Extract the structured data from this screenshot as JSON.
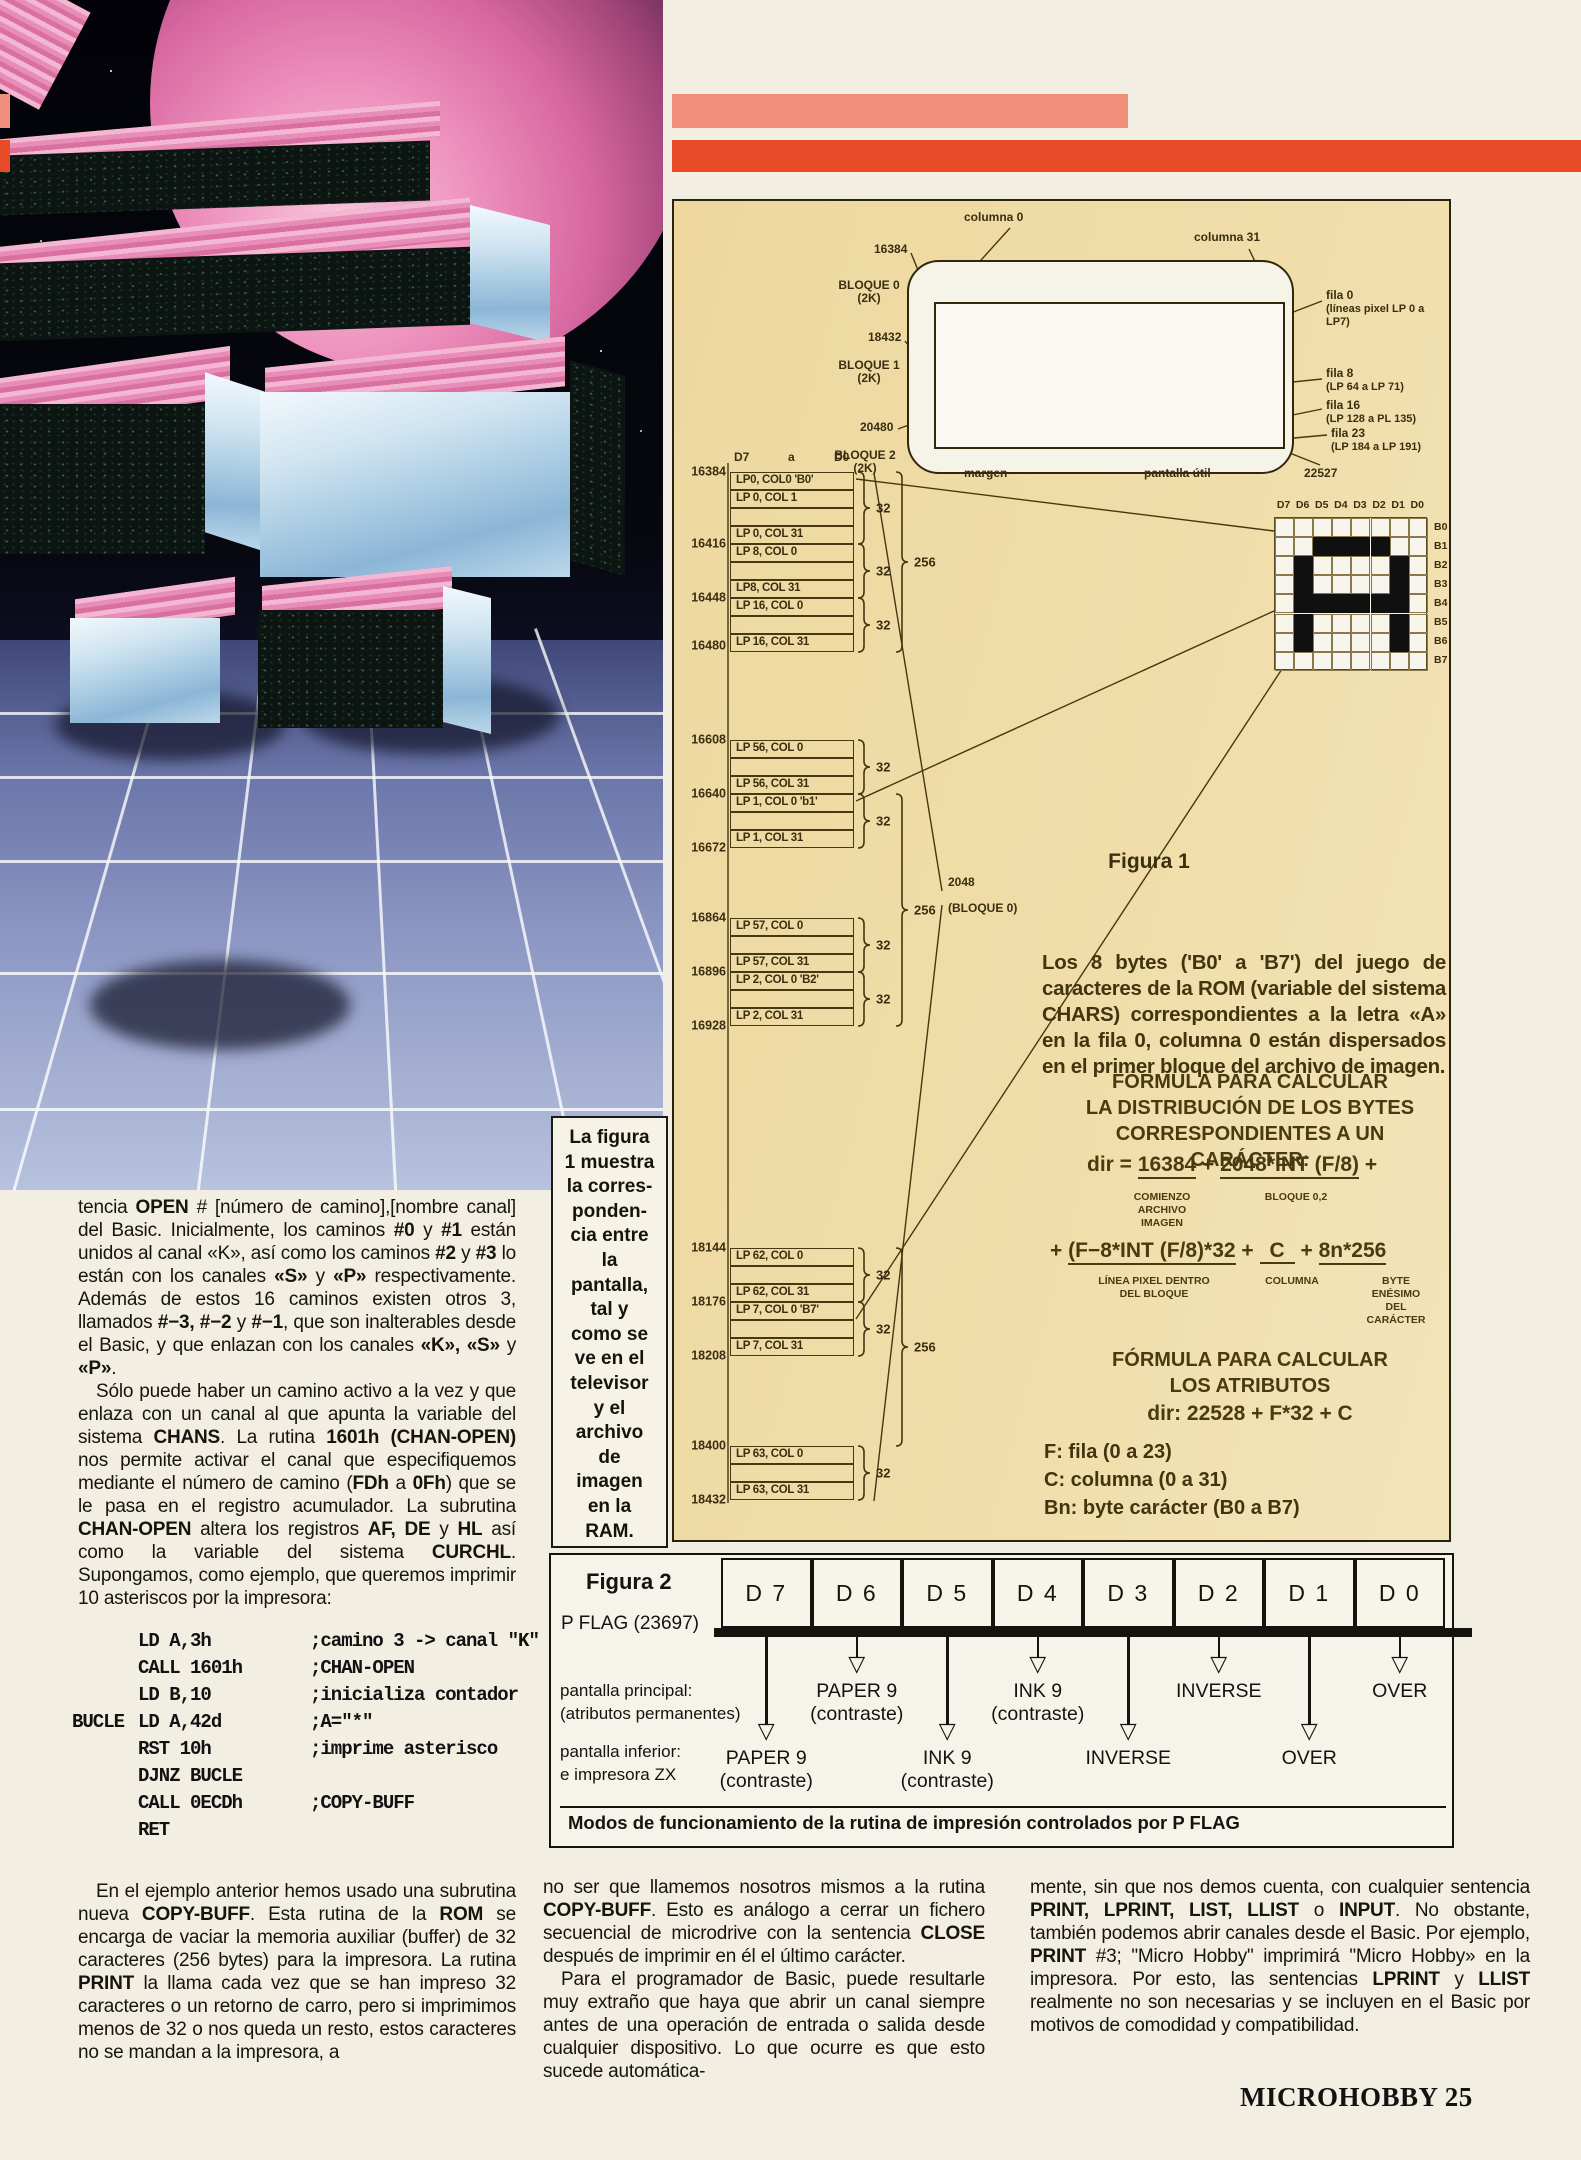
{
  "colors": {
    "stripe_red": "#e84b28",
    "stripe_salmon": "#f0907a",
    "panel_tan": "#eed9a2",
    "page": "#f2eee2"
  },
  "figura1": {
    "figura_label": "Figura 1",
    "tv": {
      "col0": "columna 0",
      "col31": "columna 31",
      "addr_left": [
        "16384",
        "18432",
        "20480"
      ],
      "blocks": [
        {
          "l1": "BLOQUE 0",
          "l2": "(2K)"
        },
        {
          "l1": "BLOQUE 1",
          "l2": "(2K)"
        },
        {
          "l1": "BLOQUE 2",
          "l2": "(2K)"
        }
      ],
      "filas": [
        {
          "l1": "fila 0",
          "l2": "(líneas pixel LP 0 a LP7)"
        },
        {
          "l1": "fila 8",
          "l2": "(LP 64 a LP 71)"
        },
        {
          "l1": "fila 16",
          "l2": "(LP 128 a PL 135)"
        },
        {
          "l1": "fila 23",
          "l2": "(LP 184 a LP 191)"
        }
      ],
      "margen": "margen",
      "pantalla_util": "pantalla útil",
      "addr_bottom": "22527"
    },
    "bus": {
      "d7": "D7",
      "a": "a",
      "d0": "D0"
    },
    "memory_map": {
      "cells": [
        {
          "top": 0,
          "label": "LP0, COL0 'B0'"
        },
        {
          "top": 18,
          "label": "LP 0, COL 1"
        },
        {
          "top": 36,
          "label": ""
        },
        {
          "top": 54,
          "label": "LP 0, COL 31"
        },
        {
          "top": 72,
          "label": "LP 8, COL 0"
        },
        {
          "top": 90,
          "label": ""
        },
        {
          "top": 108,
          "label": "LP8, COL 31"
        },
        {
          "top": 126,
          "label": "LP 16, COL 0"
        },
        {
          "top": 144,
          "label": ""
        },
        {
          "top": 162,
          "label": "LP 16, COL 31"
        },
        {
          "top": 268,
          "label": "LP 56, COL 0"
        },
        {
          "top": 286,
          "label": ""
        },
        {
          "top": 304,
          "label": "LP 56, COL 31"
        },
        {
          "top": 322,
          "label": "LP 1, COL 0 'b1'"
        },
        {
          "top": 340,
          "label": ""
        },
        {
          "top": 358,
          "label": "LP 1, COL 31"
        },
        {
          "top": 446,
          "label": "LP 57, COL 0"
        },
        {
          "top": 464,
          "label": ""
        },
        {
          "top": 482,
          "label": "LP 57, COL 31"
        },
        {
          "top": 500,
          "label": "LP 2, COL 0 'B2'"
        },
        {
          "top": 518,
          "label": ""
        },
        {
          "top": 536,
          "label": "LP 2, COL 31"
        },
        {
          "top": 776,
          "label": "LP 62, COL 0"
        },
        {
          "top": 794,
          "label": ""
        },
        {
          "top": 812,
          "label": "LP 62, COL 31"
        },
        {
          "top": 830,
          "label": "LP 7, COL 0 'B7'"
        },
        {
          "top": 848,
          "label": ""
        },
        {
          "top": 866,
          "label": "LP 7, COL 31"
        },
        {
          "top": 974,
          "label": "LP 63, COL 0"
        },
        {
          "top": 992,
          "label": ""
        },
        {
          "top": 1010,
          "label": "LP 63, COL 31"
        }
      ],
      "addresses": [
        {
          "y": 0,
          "label": "16384"
        },
        {
          "y": 72,
          "label": "16416"
        },
        {
          "y": 126,
          "label": "16448"
        },
        {
          "y": 174,
          "label": "16480"
        },
        {
          "y": 268,
          "label": "16608"
        },
        {
          "y": 322,
          "label": "16640"
        },
        {
          "y": 376,
          "label": "16672"
        },
        {
          "y": 446,
          "label": "16864"
        },
        {
          "y": 500,
          "label": "16896"
        },
        {
          "y": 554,
          "label": "16928"
        },
        {
          "y": 776,
          "label": "18144"
        },
        {
          "y": 830,
          "label": "18176"
        },
        {
          "y": 884,
          "label": "18208"
        },
        {
          "y": 974,
          "label": "18400"
        },
        {
          "y": 1028,
          "label": "18432"
        }
      ],
      "label_32": "32",
      "braces_32": [
        {
          "y1": 0,
          "y2": 72
        },
        {
          "y1": 72,
          "y2": 126
        },
        {
          "y1": 126,
          "y2": 180
        },
        {
          "y1": 268,
          "y2": 322
        },
        {
          "y1": 322,
          "y2": 376
        },
        {
          "y1": 446,
          "y2": 500
        },
        {
          "y1": 500,
          "y2": 554
        },
        {
          "y1": 776,
          "y2": 830
        },
        {
          "y1": 830,
          "y2": 884
        },
        {
          "y1": 974,
          "y2": 1028
        }
      ],
      "label_256": "256",
      "braces_256": [
        {
          "y1": 0,
          "y2": 180,
          "ly": 90
        },
        {
          "y1": 322,
          "y2": 554,
          "ly": 438
        },
        {
          "y1": 776,
          "y2": 974,
          "ly": 875
        }
      ],
      "block_label_line1": "2048",
      "block_label_line2": "(BLOQUE 0)"
    },
    "char_grid": {
      "headers": [
        "D7",
        "D6",
        "D5",
        "D4",
        "D3",
        "D2",
        "D1",
        "D0"
      ],
      "row_labels": [
        "B0",
        "B1",
        "B2",
        "B3",
        "B4",
        "B5",
        "B6",
        "B7"
      ],
      "bitmap": [
        "00000000",
        "00111100",
        "01000010",
        "01000010",
        "01111110",
        "01000010",
        "01000010",
        "00000000"
      ]
    },
    "text_html": "<b>Los 8 bytes</b> (<b>'B0'</b> a <b>'B7'</b>) del juego de caracteres de la ROM (variable del sistema CHARS) correspondientes a la letra «A» en la fila 0, columna 0 están dispersados en el primer bloque del archivo de imagen.",
    "formula_title": [
      "FÓRMULA PARA CALCULAR",
      "LA DISTRIBUCIÓN DE LOS BYTES",
      "CORRESPONDIENTES A UN CARÁCTER:"
    ],
    "f1": {
      "lead": "dir = ",
      "t1": "16384",
      "plus1": " + ",
      "t2": "2048*INT (F/8)",
      "tail": " +",
      "sub1": "COMIENZO\nARCHIVO\nIMAGEN",
      "sub2": "BLOQUE 0,2"
    },
    "f2": {
      "lead": "+ ",
      "t1": "(F−8*INT (F/8)*32",
      "plus1": " + ",
      "t2": "C",
      "plus2": " + ",
      "t3": "8n*256",
      "sub1": "LÍNEA PIXEL DENTRO\nDEL BLOQUE",
      "sub2": "COLUMNA",
      "sub3": "BYTE ENÉSIMO\nDEL CARÁCTER"
    },
    "formula2_title": [
      "FÓRMULA PARA CALCULAR",
      "LOS ATRIBUTOS"
    ],
    "formula2": "dir: 22528 + F*32 + C",
    "legend": [
      "F: fila (0 a 23)",
      "C: columna (0 a 31)",
      "Bn: byte carácter (B0 a B7)"
    ]
  },
  "sidebar_note": "La figura\n1 muestra\nla corres-\nponden-\ncia entre\nla\npantalla,\ntal y\ncomo se\nve en el\ntelevisor\ny el\narchivo\nde\nimagen\nen la\nRAM.",
  "article": {
    "col1_p1_html": "tencia <b>OPEN</b> # [número de camino],[nombre canal] del Basic. Inicialmente, los caminos <b>#0</b> y <b>#1</b> están unidos al canal «K», así como los caminos <b>#2</b> y <b>#3</b> lo están con los canales <b>«S»</b> y <b>«P»</b> respectivamente. Además de estos 16 caminos existen otros 3, llamados <b>#−3, #−2</b> y <b>#−1</b>, que son inalterables desde el Basic, y que enlazan con los canales <b>«K», «S»</b> y <b>«P»</b>.",
    "col1_p2_html": "Sólo puede haber un camino activo a la vez y que enlaza con un canal al que apunta la variable del sistema <b>CHANS</b>. La rutina <b>1601h (CHAN-OPEN)</b> nos permite activar el canal que especifiquemos mediante el número de camino (<b>FDh</b> a <b>0Fh</b>) que se le pasa en el registro acumulador. La subrutina <b>CHAN-OPEN</b> altera los registros <b>AF, DE</b> y <b>HL</b> así como la variable del sistema <b>CURCHL</b>. Supongamos, como ejemplo, que queremos imprimir 10 asteriscos por la impresora:",
    "code": [
      {
        "lab": "",
        "ins": "LD A,3h",
        "com": ";camino 3 -> canal \"K\""
      },
      {
        "lab": "",
        "ins": "CALL 1601h",
        "com": ";CHAN-OPEN"
      },
      {
        "lab": "",
        "ins": "LD B,10",
        "com": ";inicializa contador"
      },
      {
        "lab": "BUCLE",
        "ins": "LD A,42d",
        "com": ";A=\"*\""
      },
      {
        "lab": "",
        "ins": "RST 10h",
        "com": ";imprime asterisco"
      },
      {
        "lab": "",
        "ins": "DJNZ BUCLE",
        "com": ""
      },
      {
        "lab": "",
        "ins": "CALL 0ECDh",
        "com": ";COPY-BUFF"
      },
      {
        "lab": "",
        "ins": "RET",
        "com": ""
      }
    ],
    "col1_p3_html": "En el ejemplo anterior hemos usado una subrutina nueva <b>COPY-BUFF</b>. Esta rutina de la <b>ROM</b> se encarga de vaciar la memoria auxiliar (buffer) de 32 caracteres (256 bytes) para la impresora. La rutina <b>PRINT</b> la llama cada vez que se han impreso 32 caracteres o un retorno de carro, pero si imprimimos menos de 32 o nos queda un resto, estos caracteres no se mandan a la impresora, a",
    "col2_p1_html": "no ser que llamemos nosotros mismos a la rutina <b>COPY-BUFF</b>. Esto es análogo a cerrar un fichero secuencial de microdrive con la sentencia <b>CLOSE</b> después de imprimir en él el último carácter.",
    "col2_p2_html": "Para el programador de Basic, puede resultarle muy extraño que haya que abrir un canal siempre antes de una operación de entrada o salida desde cualquier dispositivo. Lo que ocurre es que esto sucede automática-",
    "col3_p1_html": "mente, sin que nos demos cuenta, con cualquier sentencia <b>PRINT, LPRINT, LIST, LLIST</b> o <b>INPUT</b>. No obstante, también podemos abrir canales desde el Basic. Por ejemplo, <b>PRINT</b> #3; \"Micro Hobby\" imprimirá \"Micro Hobby» en la impresora. Por esto, las sentencias <b>LPRINT</b> y <b>LLIST</b> realmente no son necesarias y se incluyen en el Basic por motivos de comodidad y compatibilidad."
  },
  "figura2": {
    "label": "Figura 2",
    "pflag": "P FLAG (23697)",
    "bits": [
      "D 7",
      "D 6",
      "D 5",
      "D 4",
      "D 3",
      "D 2",
      "D 1",
      "D 0"
    ],
    "row1_heading1": "pantalla principal:",
    "row1_heading2": "(atributos permanentes)",
    "row1": [
      {
        "bit": 1,
        "label": "PAPER 9\n(contraste)"
      },
      {
        "bit": 3,
        "label": "INK 9\n(contraste)"
      },
      {
        "bit": 5,
        "label": "INVERSE"
      },
      {
        "bit": 7,
        "label": "OVER"
      }
    ],
    "row2_heading1": "pantalla inferior:",
    "row2_heading2": "e impresora ZX",
    "row2": [
      {
        "bit": 0,
        "label": "PAPER 9\n(contraste)"
      },
      {
        "bit": 2,
        "label": "INK 9\n(contraste)"
      },
      {
        "bit": 4,
        "label": "INVERSE"
      },
      {
        "bit": 6,
        "label": "OVER"
      }
    ],
    "caption": "Modos de funcionamiento de la rutina de impresión controlados por P FLAG"
  },
  "footer": "MICROHOBBY 25"
}
